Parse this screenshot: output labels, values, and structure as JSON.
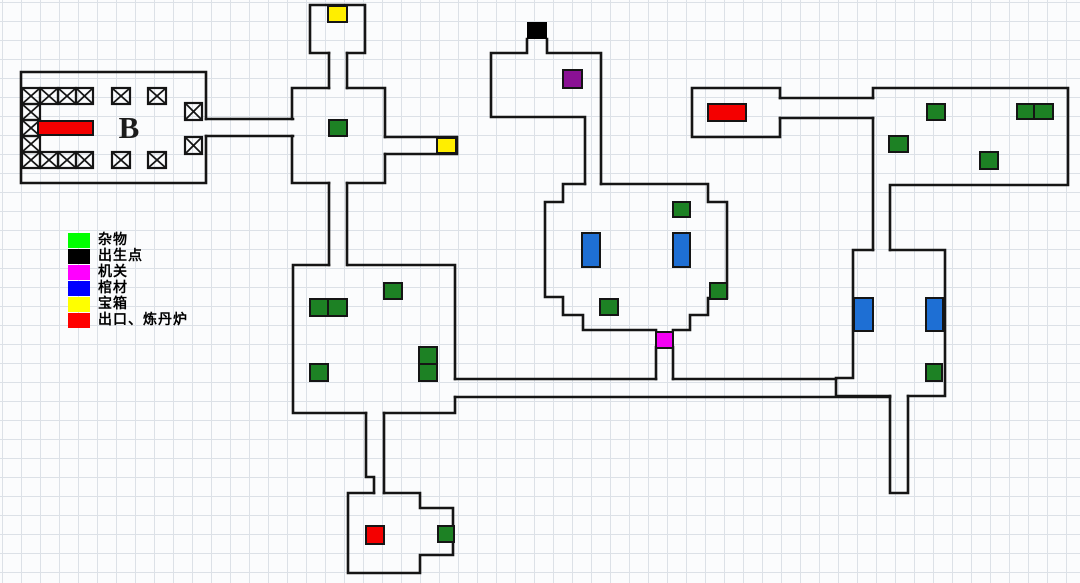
{
  "legend": {
    "items": [
      {
        "key": "junk",
        "label": "杂物",
        "color": "#00ff00"
      },
      {
        "key": "spawn",
        "label": "出生点",
        "color": "#000000"
      },
      {
        "key": "mechanism",
        "label": "机关",
        "color": "#ff00ff"
      },
      {
        "key": "coffin",
        "label": "棺材",
        "color": "#0000ff"
      },
      {
        "key": "chest",
        "label": "宝箱",
        "color": "#ffff00"
      },
      {
        "key": "exit",
        "label": "出口、炼丹炉",
        "color": "#ff0000"
      }
    ]
  },
  "map": {
    "room_label": "B",
    "colors": {
      "junk": "#1d8124",
      "spawn": "#000000",
      "mechanism": "#f400f4",
      "mechanism-dark": "#8a1194",
      "coffin": "#1e6fd4",
      "chest": "#ffee00",
      "exit": "#f40000",
      "wall": "#151515"
    },
    "items": [
      {
        "type": "chest",
        "x": 328,
        "y": 6,
        "w": 19,
        "h": 16
      },
      {
        "type": "spawn",
        "x": 527,
        "y": 22,
        "w": 20,
        "h": 17
      },
      {
        "type": "mechanism-dark",
        "x": 563,
        "y": 70,
        "w": 19,
        "h": 18
      },
      {
        "type": "exit",
        "x": 38,
        "y": 121,
        "w": 55,
        "h": 14
      },
      {
        "type": "exit",
        "x": 708,
        "y": 104,
        "w": 38,
        "h": 17
      },
      {
        "type": "junk",
        "x": 329,
        "y": 120,
        "w": 18,
        "h": 16
      },
      {
        "type": "chest",
        "x": 437,
        "y": 138,
        "w": 19,
        "h": 15
      },
      {
        "type": "junk",
        "x": 927,
        "y": 104,
        "w": 18,
        "h": 16
      },
      {
        "type": "junk",
        "x": 1017,
        "y": 104,
        "w": 17,
        "h": 15
      },
      {
        "type": "junk",
        "x": 1034,
        "y": 104,
        "w": 19,
        "h": 15
      },
      {
        "type": "junk",
        "x": 889,
        "y": 136,
        "w": 19,
        "h": 16
      },
      {
        "type": "junk",
        "x": 980,
        "y": 152,
        "w": 18,
        "h": 17
      },
      {
        "type": "junk",
        "x": 673,
        "y": 202,
        "w": 17,
        "h": 15
      },
      {
        "type": "coffin",
        "x": 582,
        "y": 233,
        "w": 18,
        "h": 34
      },
      {
        "type": "coffin",
        "x": 673,
        "y": 233,
        "w": 17,
        "h": 34
      },
      {
        "type": "junk",
        "x": 710,
        "y": 283,
        "w": 17,
        "h": 16
      },
      {
        "type": "junk",
        "x": 600,
        "y": 299,
        "w": 18,
        "h": 16
      },
      {
        "type": "mechanism",
        "x": 656,
        "y": 332,
        "w": 17,
        "h": 16
      },
      {
        "type": "junk",
        "x": 384,
        "y": 283,
        "w": 18,
        "h": 16
      },
      {
        "type": "junk",
        "x": 310,
        "y": 299,
        "w": 18,
        "h": 17
      },
      {
        "type": "junk",
        "x": 328,
        "y": 299,
        "w": 19,
        "h": 17
      },
      {
        "type": "junk",
        "x": 310,
        "y": 364,
        "w": 18,
        "h": 17
      },
      {
        "type": "junk",
        "x": 419,
        "y": 347,
        "w": 18,
        "h": 17
      },
      {
        "type": "junk",
        "x": 419,
        "y": 364,
        "w": 18,
        "h": 17
      },
      {
        "type": "coffin",
        "x": 854,
        "y": 298,
        "w": 19,
        "h": 33
      },
      {
        "type": "coffin",
        "x": 926,
        "y": 298,
        "w": 17,
        "h": 33
      },
      {
        "type": "junk",
        "x": 926,
        "y": 364,
        "w": 16,
        "h": 17
      },
      {
        "type": "exit",
        "x": 366,
        "y": 526,
        "w": 18,
        "h": 18
      },
      {
        "type": "junk",
        "x": 438,
        "y": 526,
        "w": 16,
        "h": 16
      }
    ],
    "crosses": [
      [
        22,
        88,
        18,
        16
      ],
      [
        40,
        88,
        18,
        16
      ],
      [
        58,
        88,
        18,
        16
      ],
      [
        76,
        88,
        17,
        16
      ],
      [
        112,
        88,
        18,
        16
      ],
      [
        148,
        88,
        18,
        16
      ],
      [
        22,
        104,
        18,
        16
      ],
      [
        22,
        120,
        18,
        16
      ],
      [
        22,
        136,
        18,
        16
      ],
      [
        22,
        152,
        18,
        16
      ],
      [
        40,
        152,
        18,
        16
      ],
      [
        58,
        152,
        18,
        16
      ],
      [
        76,
        152,
        17,
        16
      ],
      [
        112,
        152,
        18,
        16
      ],
      [
        148,
        152,
        18,
        16
      ],
      [
        185,
        103,
        17,
        17
      ],
      [
        185,
        137,
        17,
        17
      ]
    ]
  }
}
